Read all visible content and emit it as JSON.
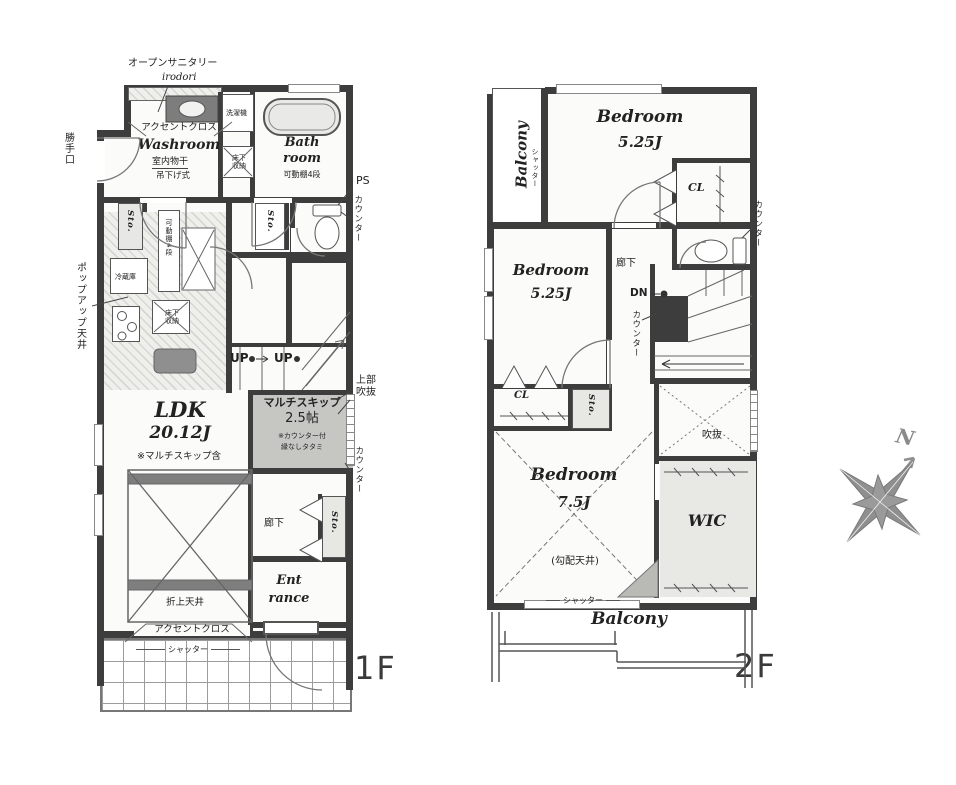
{
  "shared": {
    "sto": "Sto.",
    "counter": "カウンター",
    "shutter": "シャッター",
    "cl": "CL",
    "up": "UP",
    "accent_cloth": "アクセントクロス",
    "floor_storage": "床下収納",
    "balcony": "Balcony",
    "bedroom": "Bedroom",
    "size_525": "5.25J",
    "corridor": "廊下",
    "movable_shelf": "可動棚4段"
  },
  "floor1": {
    "label": "1F",
    "open_sanitary": "オープンサニタリー",
    "open_sanitary_sub": "irodori",
    "washroom": "Washroom",
    "indoor_drying": "室内物干",
    "hanging_type": "吊下げ式",
    "washing_machine": "洗濯機",
    "bath_line1": "Bath",
    "bath_line2": "room",
    "back_door": "勝手口",
    "ps": "PS",
    "fridge": "冷蔵庫",
    "popup_ceiling": "ポップアップ天井",
    "multi_skip_line1": "マルチスキップ",
    "multi_skip_line2": "2.5帖",
    "multi_skip_note1": "※カウンター付",
    "multi_skip_note2": "縁なしタタミ",
    "upper_void_line1": "上部",
    "upper_void_line2": "吹抜",
    "ldk": "LDK",
    "ldk_size": "20.12J",
    "ldk_note": "※マルチスキップ含",
    "folded_ceiling": "折上天井",
    "entrance_line1": "Ent",
    "entrance_line2": "rance"
  },
  "floor2": {
    "label": "2F",
    "bedroom3_size": "7.5J",
    "bedroom3_note": "(勾配天井)",
    "dn": "DN",
    "void": "吹抜",
    "wic": "WIC"
  },
  "compass": {
    "north": "N"
  }
}
